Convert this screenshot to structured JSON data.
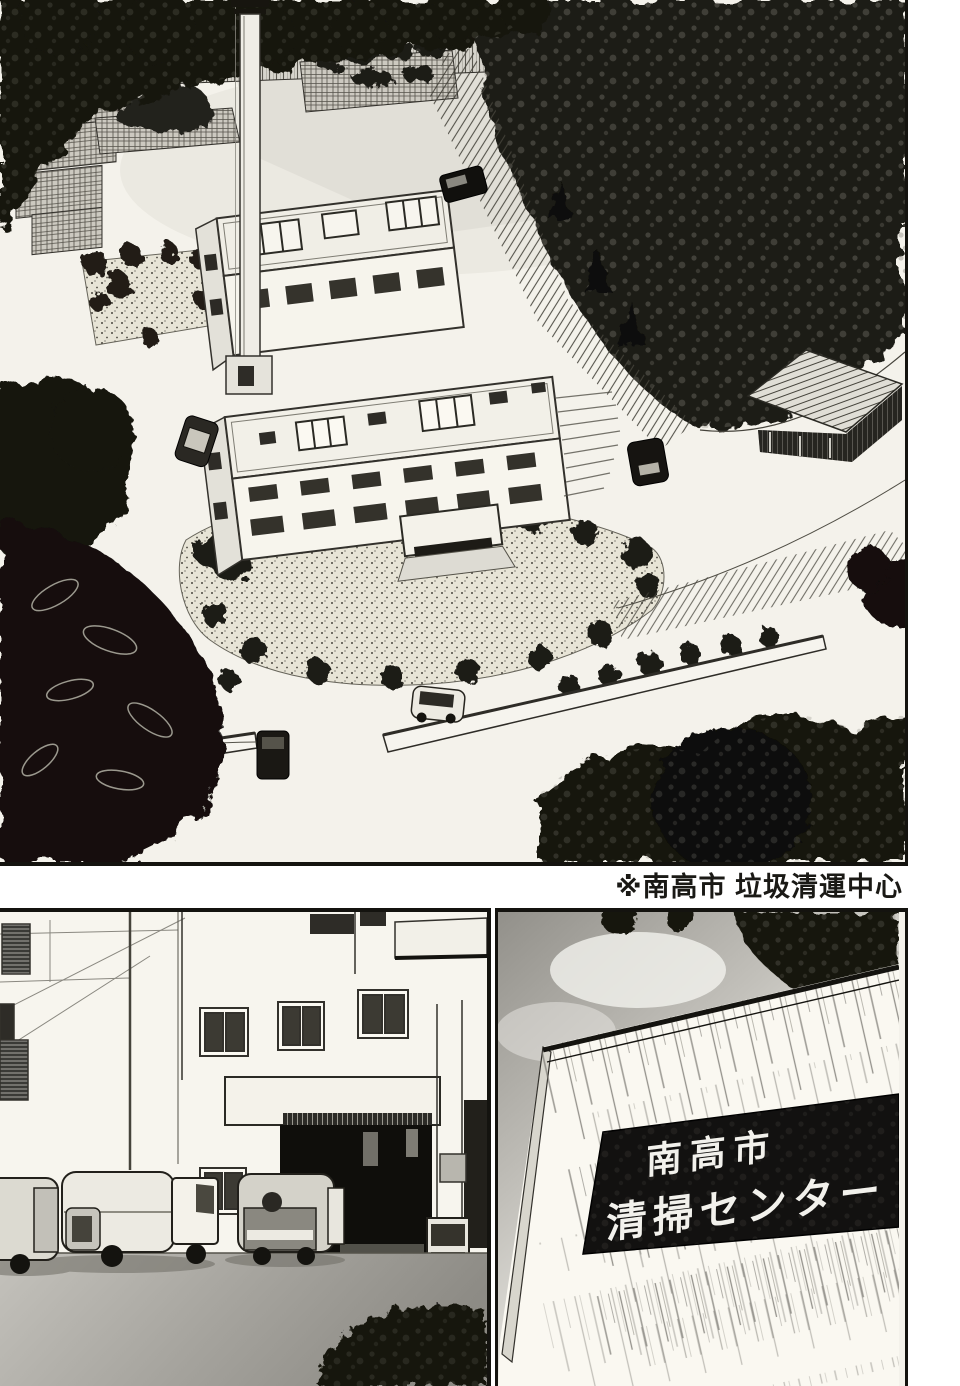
{
  "page": {
    "kind": "manga page",
    "paper_color": "#f4f2eb",
    "ink_color": "#14130f",
    "tone_gray": "#9a988f"
  },
  "caption": {
    "text": "※南高市 垃圾清運中心"
  },
  "panels": {
    "aerial": {
      "label": "aerial view of waste incineration plant"
    },
    "trucks": {
      "label": "garbage trucks at plant garage entrance"
    },
    "sign": {
      "label": "facility wall sign",
      "line1": "南高市",
      "line2": "清掃センター"
    }
  }
}
